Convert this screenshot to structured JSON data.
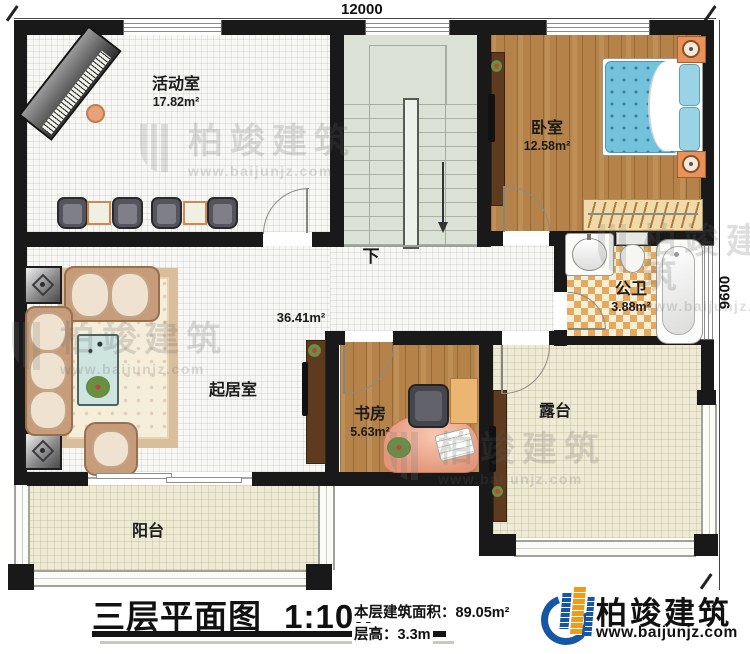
{
  "dimensions": {
    "top": "12000",
    "right": "9600"
  },
  "rooms": {
    "activity": {
      "name": "活动室",
      "area": "17.82m²"
    },
    "bedroom": {
      "name": "卧室",
      "area": "12.58m²"
    },
    "bathroom": {
      "name": "公卫",
      "area": "3.88m²"
    },
    "living": {
      "name": "起居室",
      "area": "36.41m²"
    },
    "study": {
      "name": "书房",
      "area": "5.63m²"
    },
    "terrace": {
      "name": "露台"
    },
    "balcony": {
      "name": "阳台"
    }
  },
  "stairs": {
    "down_label": "下"
  },
  "title": {
    "plan_name": "三层平面图",
    "scale": "1:100"
  },
  "notes": {
    "floor_area_label": "本层建筑面积：",
    "floor_area_value": "89.05m²",
    "floor_height_label": "层高：",
    "floor_height_value": "3.3m"
  },
  "brand": {
    "name": "柏竣建筑",
    "website": "www.baijunjz.com"
  },
  "watermark": {
    "name": "柏竣建筑",
    "website": "www.baijunjz.com"
  },
  "colors": {
    "wall": "#191919",
    "wood": "#b5834a",
    "stairs": "#dce1d6",
    "terrace": "#edead6",
    "checker_tile": "#e2a95f",
    "bed_blue": "#74c3dd",
    "sofa_tan": "#c69c7b",
    "brand_blue": "#1557a5",
    "brand_orange": "#f09a1d"
  }
}
